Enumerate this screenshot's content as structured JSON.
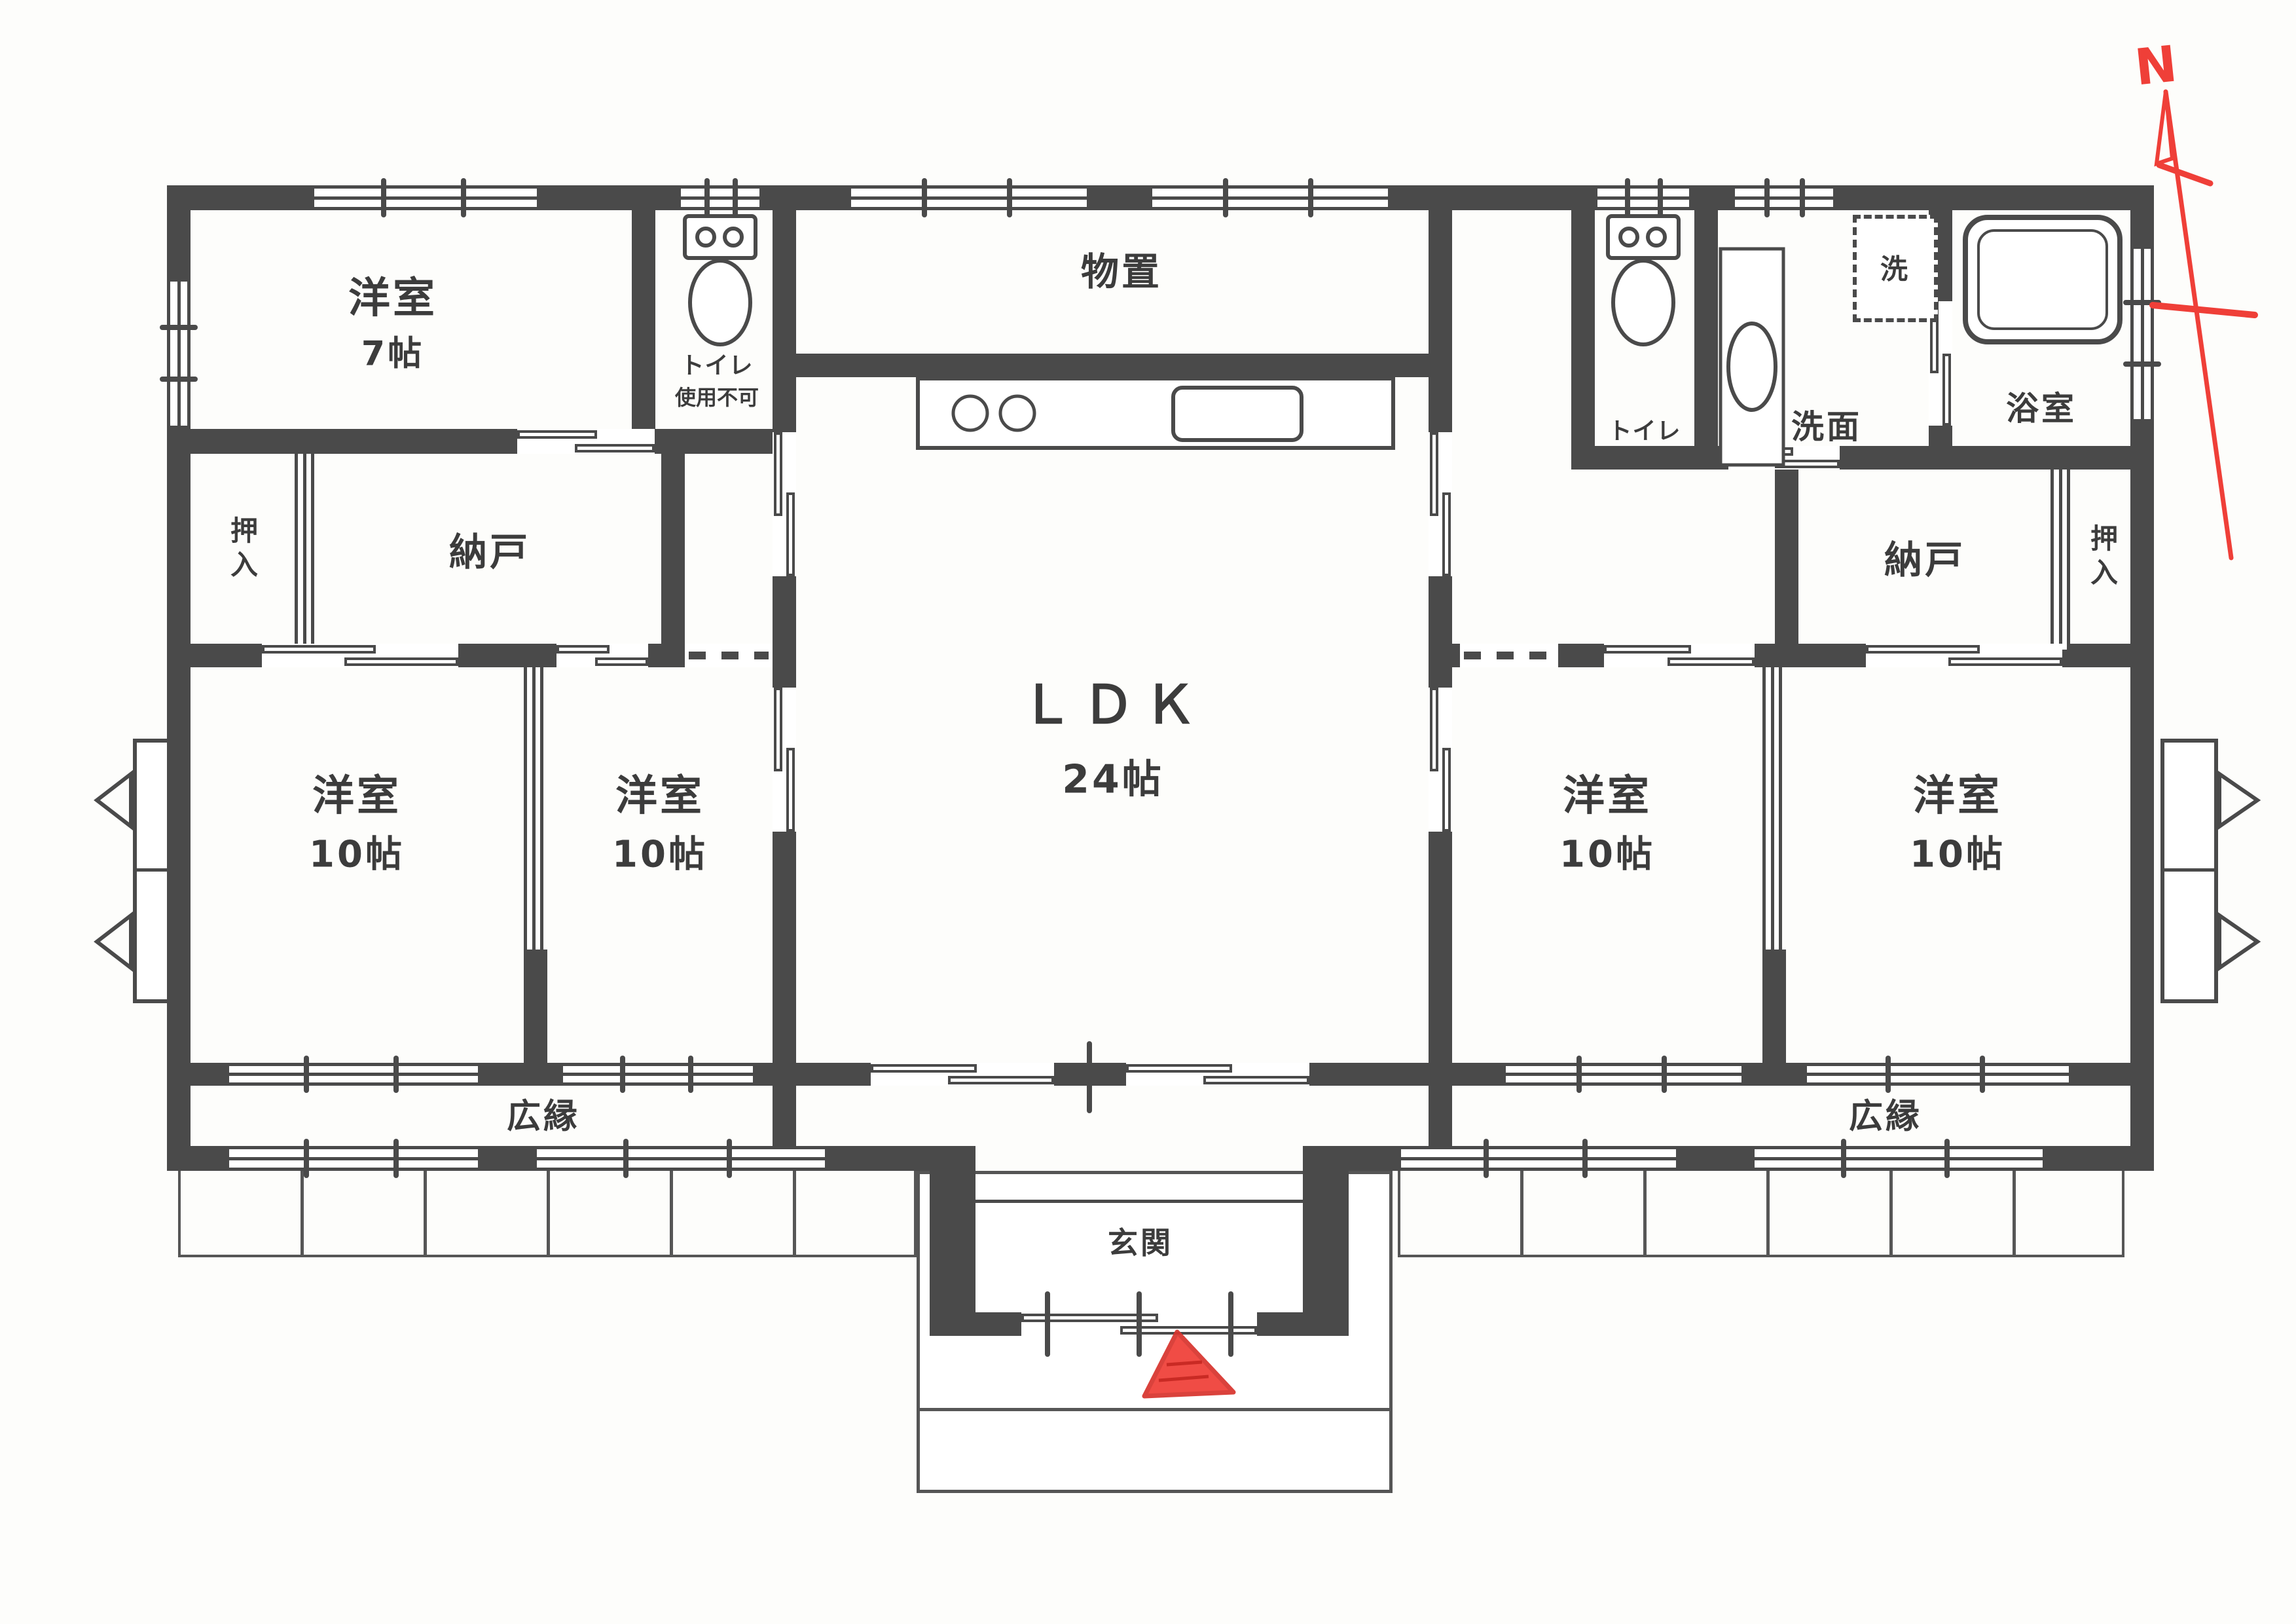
{
  "document_type": "floor-plan-scan",
  "colors": {
    "wall": "#4a4a4a",
    "annotation_red": "#ef3f38",
    "paper": "#fdfdfb"
  },
  "compass": {
    "label": "N"
  },
  "rooms": {
    "yoshitsu7": {
      "name": "洋室",
      "size": "7帖"
    },
    "toilet_unusable": {
      "name": "トイレ",
      "note": "使用不可"
    },
    "monooki": {
      "name": "物置"
    },
    "toilet": {
      "name": "トイレ"
    },
    "senmen": {
      "name": "洗面"
    },
    "washer": {
      "name": "洗"
    },
    "yokushitsu": {
      "name": "浴室"
    },
    "oshiire_left": {
      "name": "押入"
    },
    "nando_left": {
      "name": "納戸"
    },
    "nando_right": {
      "name": "納戸"
    },
    "oshiire_right": {
      "name": "押入"
    },
    "ldk": {
      "name": "ＬＤＫ",
      "size": "24帖"
    },
    "bedrooms": [
      {
        "name": "洋室",
        "size": "10帖"
      },
      {
        "name": "洋室",
        "size": "10帖"
      },
      {
        "name": "洋室",
        "size": "10帖"
      },
      {
        "name": "洋室",
        "size": "10帖"
      }
    ],
    "hiroen_left": {
      "name": "広縁"
    },
    "hiroen_right": {
      "name": "広縁"
    },
    "genkan": {
      "name": "玄関"
    }
  }
}
